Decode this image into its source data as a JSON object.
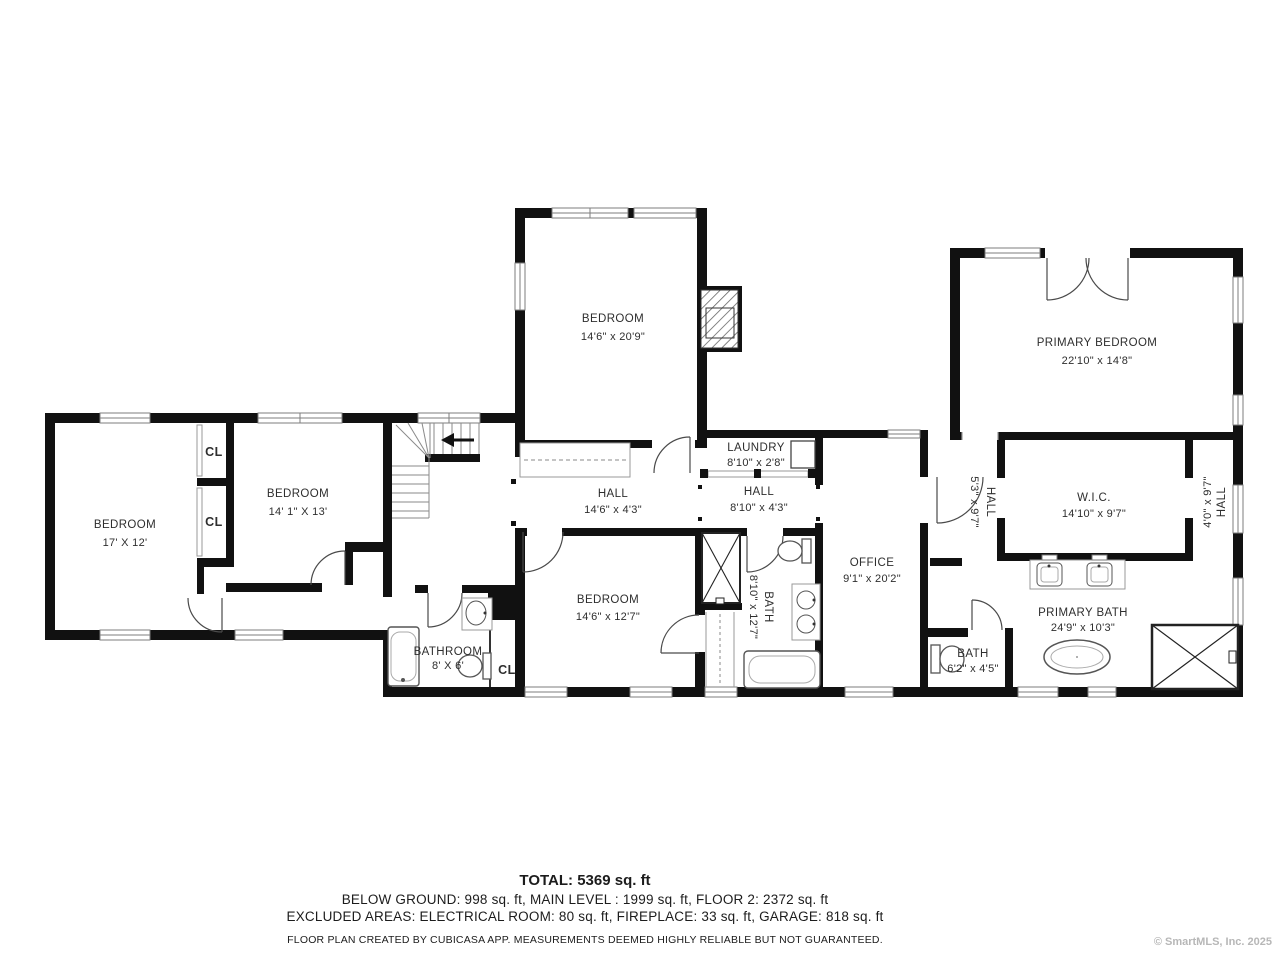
{
  "plan": {
    "rooms": {
      "bedroom_top": {
        "name": "BEDROOM",
        "dims": "14'6\" x 20'9\""
      },
      "primary_bedroom": {
        "name": "PRIMARY BEDROOM",
        "dims": "22'10\" x 14'8\""
      },
      "bedroom_left": {
        "name": "BEDROOM",
        "dims": "17' X 12'"
      },
      "bedroom_left2": {
        "name": "BEDROOM",
        "dims": "14' 1\" X 13'"
      },
      "closet1": {
        "name": "CL"
      },
      "closet2": {
        "name": "CL"
      },
      "closet3": {
        "name": "CL"
      },
      "hall_main": {
        "name": "HALL",
        "dims": "14'6\" x 4'3\""
      },
      "laundry": {
        "name": "LAUNDRY",
        "dims": "8'10\" x 2'8\""
      },
      "hall_small": {
        "name": "HALL",
        "dims": "8'10\" x 4'3\""
      },
      "wic": {
        "name": "W.I.C.",
        "dims": "14'10\" x 9'7\""
      },
      "hall_left_vert": {
        "name": "HALL",
        "dims": "5'3\" x 9'7\""
      },
      "hall_right_vert": {
        "name": "HALL",
        "dims": "4'0\" x 9'7\""
      },
      "bedroom_bottom": {
        "name": "BEDROOM",
        "dims": "14'6\" x 12'7\""
      },
      "bath_vert": {
        "name": "BATH",
        "dims": "8'10\" x 12'7\""
      },
      "office": {
        "name": "OFFICE",
        "dims": "9'1\" x 20'2\""
      },
      "bathroom": {
        "name": "BATHROOM",
        "dims": "8' X 6'"
      },
      "primary_bath": {
        "name": "PRIMARY BATH",
        "dims": "24'9\" x 10'3\""
      },
      "bath_small": {
        "name": "BATH",
        "dims": "6'2\" x 4'5\""
      }
    },
    "summary": {
      "total": "TOTAL: 5369 sq. ft",
      "levels": "BELOW GROUND: 998 sq. ft, MAIN LEVEL : 1999 sq. ft, FLOOR 2: 2372 sq. ft",
      "excluded": "EXCLUDED AREAS: ELECTRICAL ROOM: 80 sq. ft, FIREPLACE: 33 sq. ft, GARAGE: 818 sq. ft",
      "disclaimer": "FLOOR PLAN CREATED BY CUBICASA APP. MEASUREMENTS DEEMED HIGHLY RELIABLE BUT NOT GUARANTEED."
    },
    "watermark": "© SmartMLS, Inc. 2025",
    "colors": {
      "wall": "#111111",
      "text": "#2e2e2e",
      "fixture": "#555555",
      "watermark": "#b7b7b7",
      "background": "#ffffff"
    }
  }
}
